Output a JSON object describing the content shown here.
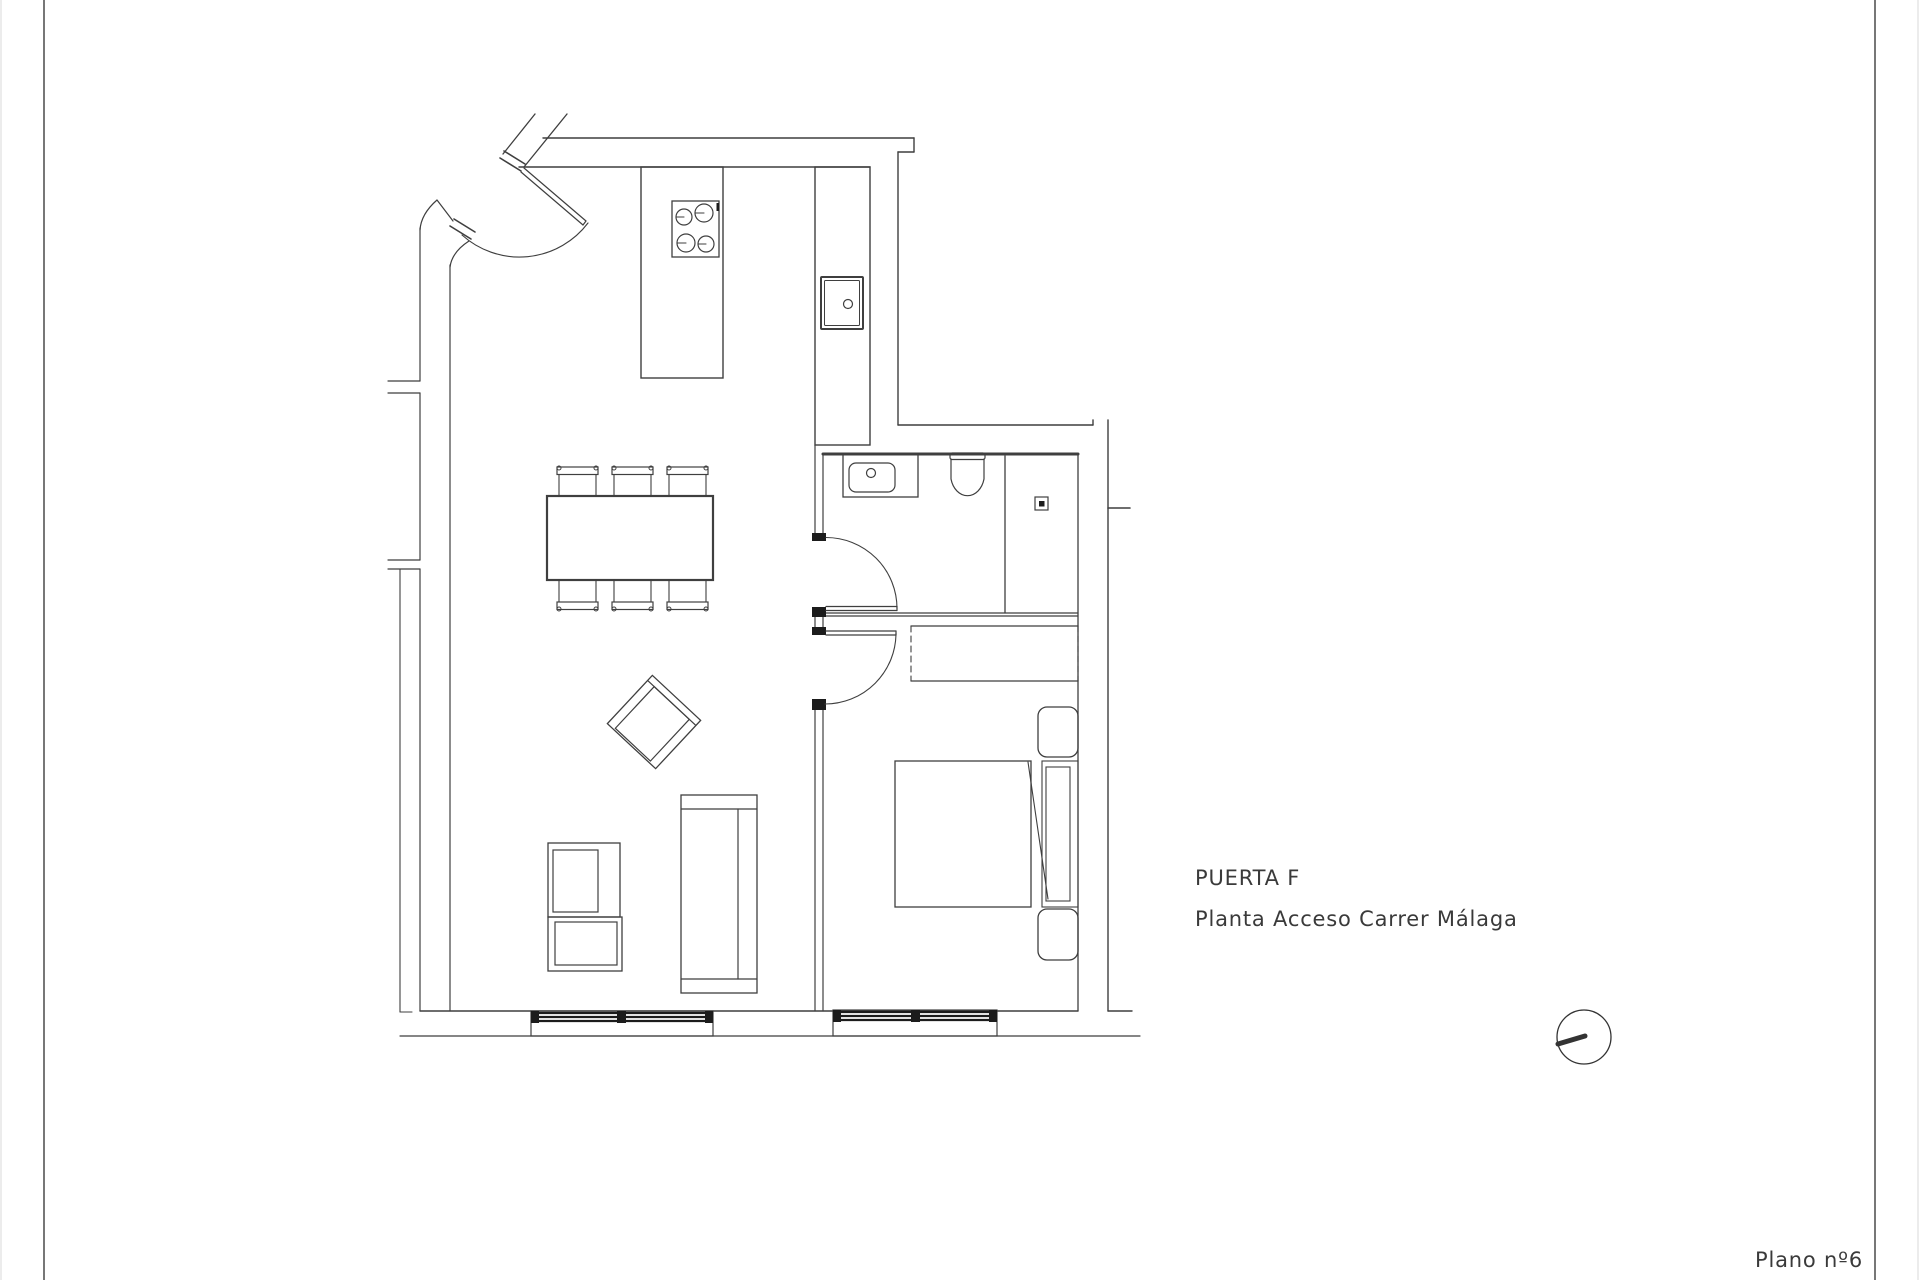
{
  "title_block": {
    "line1": "PUERTA F",
    "line2": "Planta Acceso Carrer Málaga",
    "plan_number": "Plano nº6"
  },
  "colors": {
    "background": "#ffffff",
    "line": "#3f3f3f",
    "dark": "#1c1c1c",
    "page_border": "#555555",
    "page_edge": "#d9d9d9",
    "text": "#3a3a3a"
  },
  "floor_plan": {
    "canvas": {
      "width": 1920,
      "height": 1280
    },
    "groups": [
      {
        "name": "page-edges",
        "stroke": "#d9d9d9",
        "lines": [
          [
            1,
            0,
            1,
            1280,
            1
          ],
          [
            1918,
            0,
            1918,
            1280,
            1
          ]
        ]
      },
      {
        "name": "page-border-lines",
        "stroke": "#555555",
        "lines": [
          [
            44,
            0,
            44,
            1280,
            1.6
          ],
          [
            1875,
            0,
            1875,
            1280,
            1.6
          ]
        ]
      },
      {
        "name": "exterior-walls",
        "lines": [
          [
            543,
            138,
            914,
            138,
            1.4
          ],
          [
            914,
            138,
            914,
            152,
            1.4
          ],
          [
            898,
            152,
            914,
            152,
            1.4
          ],
          [
            898,
            152,
            898,
            425,
            1.4
          ],
          [
            898,
            425,
            1093,
            425,
            1.4
          ],
          [
            1093,
            420,
            1093,
            425,
            1.4
          ],
          [
            519,
            167,
            870,
            167,
            1.4
          ],
          [
            1108,
            420,
            1108,
            1011,
            1.4
          ],
          [
            1108,
            508,
            1130,
            508,
            1.6
          ],
          [
            1078,
            454,
            1078,
            1011,
            1.3
          ],
          [
            420,
            1011,
            1078,
            1011,
            1.4
          ],
          [
            1108,
            1011,
            1132,
            1011,
            1.4
          ],
          [
            400,
            1036,
            1140,
            1036,
            1.2
          ],
          [
            420,
            228,
            420,
            381,
            1.2
          ],
          [
            420,
            393,
            420,
            560,
            1.2
          ],
          [
            420,
            569,
            420,
            1011,
            1.2
          ],
          [
            450,
            265,
            450,
            1011,
            1.2
          ],
          [
            388,
            381,
            420,
            381,
            1.2
          ],
          [
            388,
            393,
            420,
            393,
            1.2
          ],
          [
            388,
            560,
            420,
            560,
            1.2
          ],
          [
            388,
            569,
            420,
            569,
            1.2
          ],
          [
            400,
            569,
            400,
            1012,
            1.1
          ],
          [
            400,
            1012,
            412,
            1012,
            1.1
          ],
          [
            535,
            114,
            503,
            154,
            1.3
          ],
          [
            567,
            114,
            524,
            167,
            1.3
          ],
          [
            453,
            221,
            437,
            200,
            1.2
          ]
        ],
        "paths": [
          [
            "M437,200 Q421,214 420,230",
            1.2
          ],
          [
            "M469,241 Q452,252 450,267",
            1.2
          ]
        ]
      },
      {
        "name": "entrance-door",
        "lines": [
          [
            500,
            158,
            521,
            171,
            1.6
          ],
          [
            504,
            151,
            525,
            164,
            1.6
          ],
          [
            450,
            226,
            471,
            239,
            1.6
          ],
          [
            454,
            219,
            475,
            232,
            1.6
          ],
          [
            524,
            168,
            586,
            221,
            1.2
          ],
          [
            521,
            172,
            583,
            225,
            1.2
          ],
          [
            586,
            221,
            583,
            225,
            1.2
          ]
        ],
        "paths": [
          [
            "M588,223 A86,86 0 0 1 462,235",
            1.1
          ]
        ]
      },
      {
        "name": "kitchen-island",
        "rects": [
          [
            641,
            167,
            82,
            211,
            1.4,
            0
          ]
        ]
      },
      {
        "name": "cooktop",
        "rects": [
          [
            672,
            201,
            47,
            56,
            1.3,
            0
          ]
        ],
        "circles": [
          [
            684,
            217,
            8,
            1.2
          ],
          [
            704,
            213,
            9,
            1.2
          ],
          [
            686,
            243,
            9,
            1.2
          ],
          [
            706,
            244,
            8,
            1.2
          ]
        ],
        "lines": [
          [
            676,
            217,
            684,
            217,
            1.1
          ],
          [
            695,
            213,
            704,
            213,
            1.1
          ],
          [
            677,
            243,
            686,
            243,
            1.1
          ],
          [
            698,
            244,
            706,
            244,
            1.1
          ]
        ],
        "darkRects": [
          [
            716.5,
            203,
            2.5,
            8
          ]
        ]
      },
      {
        "name": "kitchen-counter",
        "rects": [
          [
            815,
            167,
            55,
            278,
            1.4,
            0
          ]
        ]
      },
      {
        "name": "kitchen-sink",
        "rects": [
          [
            821,
            277,
            42,
            52,
            2,
            1
          ],
          [
            824.5,
            280.5,
            35,
            45,
            1,
            1
          ]
        ],
        "circles": [
          [
            848,
            304,
            4.5,
            1.2
          ]
        ]
      },
      {
        "name": "interior-walls",
        "lines": [
          [
            815,
            445,
            815,
            533,
            1.2
          ],
          [
            823,
            454,
            823,
            533,
            1.2
          ],
          [
            815,
            617,
            815,
            627,
            1.2
          ],
          [
            823,
            617,
            823,
            627,
            1.2
          ],
          [
            815,
            710,
            815,
            1011,
            1.2
          ],
          [
            823,
            710,
            823,
            1011,
            1.2
          ],
          [
            823,
            613,
            1078,
            613,
            1.2
          ],
          [
            823,
            616,
            1078,
            616,
            1.2
          ],
          [
            823,
            454,
            1078,
            454,
            3
          ]
        ],
        "darkRects": [
          [
            812,
            533,
            14,
            8
          ],
          [
            812,
            607,
            14,
            10
          ],
          [
            812,
            627,
            14,
            8
          ],
          [
            812,
            699,
            14,
            11
          ]
        ]
      },
      {
        "name": "bathroom-door",
        "lines": [
          [
            826,
            606.5,
            897,
            606.5,
            1.2
          ],
          [
            826,
            610.5,
            897,
            610.5,
            1.2
          ],
          [
            897,
            606.5,
            897,
            610.5,
            1.2
          ]
        ],
        "paths": [
          [
            "M897,608.5 A71,71 0 0 0 826,537.5",
            1.1
          ]
        ]
      },
      {
        "name": "bathroom-sink",
        "rects": [
          [
            843,
            454,
            75,
            43,
            1.3,
            0
          ],
          [
            849,
            463,
            46,
            29,
            1.2,
            7
          ]
        ],
        "circles": [
          [
            871,
            473,
            4.5,
            1.2
          ]
        ]
      },
      {
        "name": "toilet",
        "rects": [
          [
            950,
            453,
            35,
            6.5,
            1.2,
            2
          ]
        ],
        "paths": [
          [
            "M951,459 L951,479 A17,22 0 0 0 984,479 L984,459",
            1.2
          ]
        ]
      },
      {
        "name": "shower",
        "lines": [
          [
            1005,
            456,
            1005,
            613,
            1.3
          ]
        ],
        "rects": [
          [
            1035,
            497,
            13,
            13,
            1.2,
            0
          ]
        ],
        "darkRects": [
          [
            1039,
            501,
            5.5,
            5.5
          ]
        ]
      },
      {
        "name": "bedroom-door",
        "lines": [
          [
            826,
            631,
            896,
            631,
            1.2
          ],
          [
            826,
            635,
            896,
            635,
            1.2
          ],
          [
            896,
            631,
            896,
            635,
            1.2
          ]
        ],
        "paths": [
          [
            "M896,633 A71,71 0 0 1 825,704",
            1.1
          ]
        ]
      },
      {
        "name": "wardrobe",
        "lines": [
          [
            911,
            626,
            1078,
            626,
            1.3
          ],
          [
            911,
            681,
            1078,
            681,
            1.3
          ]
        ],
        "dashedLines": [
          [
            911,
            626,
            911,
            681,
            1.1
          ],
          [
            1078,
            626,
            1078,
            681,
            1.1
          ]
        ]
      },
      {
        "name": "bed",
        "rects": [
          [
            895,
            761,
            136,
            146,
            1.3,
            0
          ],
          [
            1042,
            761,
            36,
            146,
            1.1,
            0
          ],
          [
            1046,
            767,
            24,
            134,
            1.1,
            0
          ]
        ],
        "lines": [
          [
            1028,
            762,
            1048,
            899,
            1.1
          ]
        ]
      },
      {
        "name": "nightstands",
        "rects": [
          [
            1038,
            707,
            40,
            50,
            1.3,
            9
          ],
          [
            1038,
            909,
            40,
            51,
            1.3,
            9
          ]
        ]
      },
      {
        "name": "dining-table",
        "rects": [
          [
            547,
            496,
            166,
            84,
            2.2,
            0
          ]
        ]
      },
      {
        "name": "dining-chairs",
        "rects": [
          [
            557,
            467,
            41,
            7.5,
            1.2,
            0
          ],
          [
            612,
            467,
            41,
            7.5,
            1.2,
            0
          ],
          [
            667,
            467,
            41,
            7.5,
            1.2,
            0
          ],
          [
            557,
            602,
            41,
            7.5,
            1.2,
            0
          ],
          [
            612,
            602,
            41,
            7.5,
            1.2,
            0
          ],
          [
            667,
            602,
            41,
            7.5,
            1.2,
            0
          ]
        ],
        "circles": [
          [
            559,
            468,
            2,
            1
          ],
          [
            596,
            468,
            2,
            1
          ],
          [
            614,
            468,
            2,
            1
          ],
          [
            651,
            468,
            2,
            1
          ],
          [
            669,
            468,
            2,
            1
          ],
          [
            706,
            468,
            2,
            1
          ],
          [
            559,
            609,
            2,
            1
          ],
          [
            596,
            609,
            2,
            1
          ],
          [
            614,
            609,
            2,
            1
          ],
          [
            651,
            609,
            2,
            1
          ],
          [
            669,
            609,
            2,
            1
          ],
          [
            706,
            609,
            2,
            1
          ]
        ],
        "lines": [
          [
            559,
            475,
            559,
            496,
            1.1
          ],
          [
            596,
            475,
            596,
            496,
            1.1
          ],
          [
            614,
            475,
            614,
            496,
            1.1
          ],
          [
            651,
            475,
            651,
            496,
            1.1
          ],
          [
            669,
            475,
            669,
            496,
            1.1
          ],
          [
            706,
            475,
            706,
            496,
            1.1
          ],
          [
            559,
            580,
            559,
            602,
            1.1
          ],
          [
            596,
            580,
            596,
            602,
            1.1
          ],
          [
            614,
            580,
            614,
            602,
            1.1
          ],
          [
            651,
            580,
            651,
            602,
            1.1
          ],
          [
            669,
            580,
            669,
            602,
            1.1
          ],
          [
            706,
            580,
            706,
            602,
            1.1
          ]
        ]
      },
      {
        "name": "armchair",
        "transform": "translate(654,722) rotate(43)",
        "rects": [
          [
            -33,
            -33,
            66,
            66,
            1.3,
            0
          ],
          [
            -24,
            -26,
            48,
            57,
            1.2,
            0
          ]
        ],
        "lines": [
          [
            -33,
            -26,
            33,
            -26,
            1.2
          ]
        ]
      },
      {
        "name": "sofa",
        "rects": [
          [
            681,
            795,
            76,
            198,
            1.3,
            0
          ]
        ],
        "lines": [
          [
            681,
            809,
            757,
            809,
            1.2
          ],
          [
            681,
            979,
            757,
            979,
            1.2
          ],
          [
            738,
            809,
            738,
            979,
            1.2
          ]
        ]
      },
      {
        "name": "tv-unit",
        "rects": [
          [
            548,
            843,
            72,
            74,
            1.3,
            0
          ],
          [
            553,
            850,
            45,
            62,
            1.2,
            0
          ],
          [
            548,
            917,
            74,
            54,
            1.3,
            0
          ],
          [
            555,
            922,
            62,
            43,
            1.2,
            0
          ]
        ]
      },
      {
        "name": "window-frames",
        "rects": [
          [
            531,
            1011,
            182,
            25,
            1.2,
            0
          ],
          [
            833,
            1010,
            164,
            26,
            1.2,
            0
          ]
        ]
      },
      {
        "name": "window-glazing",
        "stroke": "#1c1c1c",
        "lines": [
          [
            536,
            1013,
            708,
            1013,
            2.2
          ],
          [
            536,
            1017,
            708,
            1017,
            2.2
          ],
          [
            536,
            1021,
            708,
            1021,
            2.2
          ],
          [
            837,
            1012,
            993,
            1012,
            2.2
          ],
          [
            837,
            1016,
            993,
            1016,
            2.2
          ],
          [
            837,
            1020,
            993,
            1020,
            2.2
          ]
        ],
        "darkRects": [
          [
            531,
            1011,
            8,
            12
          ],
          [
            617,
            1011,
            9,
            12
          ],
          [
            705,
            1011,
            8,
            12
          ],
          [
            833,
            1010,
            8,
            12
          ],
          [
            911,
            1010,
            9,
            12
          ],
          [
            989,
            1010,
            8,
            12
          ]
        ]
      },
      {
        "name": "north-indicator",
        "stroke": "#333333",
        "circles": [
          [
            1584,
            1037,
            27,
            1.3
          ]
        ],
        "lines": [
          [
            1558,
            1044,
            1585,
            1036,
            5
          ]
        ]
      }
    ]
  }
}
